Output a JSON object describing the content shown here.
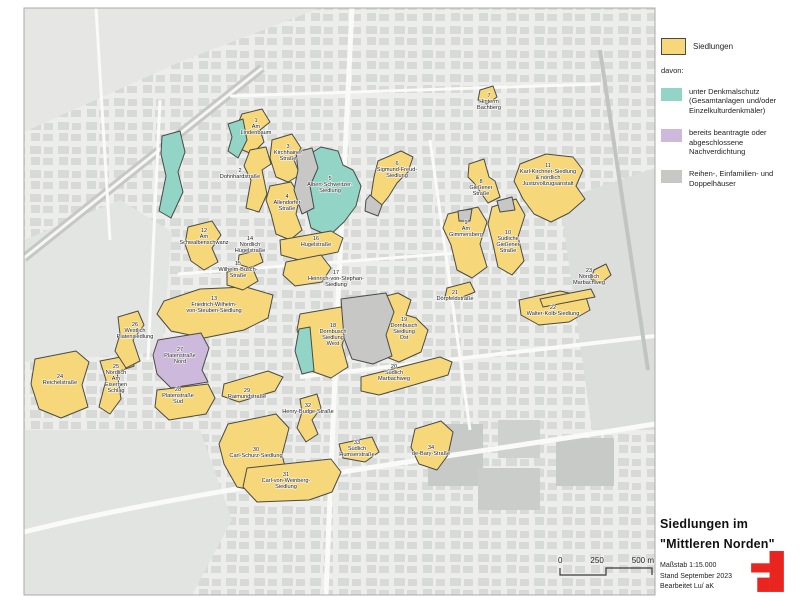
{
  "panel": {
    "legend": {
      "siedlungen_label": "Siedlungen",
      "davon_label": "davon:",
      "siedlungen_color": "#F6D87A",
      "items": [
        {
          "label": "unter Denkmalschutz (Gesamtanlagen und/oder Einzelkulturdenkmäler)",
          "color": "#92D4C5"
        },
        {
          "label": "bereits beantragte oder abgeschlossene Nachverdichtung",
          "color": "#CDB9DC"
        },
        {
          "label": "Reihen-, Einfamilien- und Doppelhäuser",
          "color": "#C7C7C5"
        }
      ]
    },
    "titleblock": {
      "line1": "Siedlungen im",
      "line2": "\"Mittleren Norden\"",
      "maszstab": "Maßstab 1:15.000",
      "stand": "Stand September 2023",
      "bearbeitet": "Bearbeitet  Lu/ aK"
    },
    "logo_color": "#E8251F"
  },
  "scalebar": {
    "t0": "0",
    "t250": "250",
    "t500": "500 m"
  },
  "map": {
    "colors": {
      "siedlung": "#F6D87A",
      "denkmalschutz": "#92D4C5",
      "nachverdichtung": "#CDB9DC",
      "reihenhaeuser": "#C7C7C5",
      "outline": "#4a4a46"
    },
    "settlements": [
      {
        "num": "1",
        "lines": [
          "Am",
          "Lindenbaum"
        ],
        "type": "s",
        "lx": 256,
        "ly": 122,
        "pts": "242,114 262,109 270,122 260,130 264,142 252,154 238,148 236,128"
      },
      {
        "num": "2",
        "lines": [
          "Dohnhardstraße"
        ],
        "type": "s",
        "lx": 240,
        "ly": 172,
        "pts": "250,150 266,147 271,164 262,170 267,194 259,212 246,208 251,180 244,166"
      },
      {
        "num": "3",
        "lines": [
          "Kirchhainer",
          "Straße"
        ],
        "type": "s",
        "lx": 288,
        "ly": 148,
        "pts": "272,140 292,134 301,148 294,160 300,175 288,182 276,177 270,158"
      },
      {
        "num": "4",
        "lines": [
          "Allendorfer",
          "Straße"
        ],
        "type": "s",
        "lx": 287,
        "ly": 198,
        "pts": "270,186 291,182 300,196 296,214 302,230 290,240 276,234 271,214 266,200"
      },
      {
        "num": "5",
        "lines": [
          "Albert-Schweitzer-",
          "Siedlung"
        ],
        "type": "d",
        "lx": 330,
        "ly": 180,
        "pts": "305,157 321,147 338,151 343,165 353,170 361,186 356,206 344,222 329,236 311,228 305,204 298,184 300,167"
      },
      {
        "num": "6",
        "lines": [
          "Sigmund-Freud-",
          "Siedlung"
        ],
        "type": "s",
        "lx": 397,
        "ly": 165,
        "pts": "378,161 401,151 413,157 408,172 397,183 389,196 381,206 371,196 374,177"
      },
      {
        "num": "7",
        "lines": [
          "Hinterm",
          "Bachberg"
        ],
        "type": "s",
        "lx": 489,
        "ly": 97,
        "pts": "480,90 493,86 497,97 487,104 478,100"
      },
      {
        "num": "8",
        "lines": [
          "Gießener",
          "Straße"
        ],
        "type": "s",
        "lx": 481,
        "ly": 183,
        "pts": "469,164 484,159 489,177 495,181 500,197 488,203 481,193 474,183 468,177"
      },
      {
        "num": "9",
        "lines": [
          "Am",
          "Gimmersberg"
        ],
        "type": "s",
        "lx": 466,
        "ly": 224,
        "pts": "448,214 478,207 487,222 480,244 487,267 472,278 457,270 451,245 443,228"
      },
      {
        "num": "10",
        "lines": [
          "Südliche",
          "Gießener",
          "Straße"
        ],
        "type": "s",
        "lx": 508,
        "ly": 234,
        "pts": "492,207 516,199 525,215 518,237 524,261 512,275 498,267 493,244 488,224"
      },
      {
        "num": "11",
        "lines": [
          "Karl-Kirchner-Siedlung",
          "& nördlich",
          "Justizvollzugsanstalt"
        ],
        "type": "s",
        "lx": 548,
        "ly": 167,
        "pts": "520,164 546,154 573,157 583,170 576,186 585,199 569,213 551,222 534,214 523,199 514,181"
      },
      {
        "num": "12",
        "lines": [
          "Am",
          "Schwalbenschwanz"
        ],
        "type": "s",
        "lx": 204,
        "ly": 232,
        "pts": "188,227 212,221 221,235 212,248 218,262 204,270 191,261 185,244"
      },
      {
        "num": "13",
        "lines": [
          "Friedrich-Wilhelm-",
          "von-Steuben-Siedlung"
        ],
        "type": "s",
        "lx": 214,
        "ly": 300,
        "pts": "164,301 200,289 246,287 273,295 268,318 244,330 204,338 171,331 157,314"
      },
      {
        "num": "14",
        "lines": [
          "Nördlich",
          "Hügelstraße"
        ],
        "type": "s",
        "lx": 250,
        "ly": 240,
        "pts": "239,255 259,250 263,262 250,268 238,264"
      },
      {
        "num": "15",
        "lines": [
          "Wilhelm-Busch-",
          "Straße"
        ],
        "type": "s",
        "lx": 238,
        "ly": 265,
        "pts": "227,272 252,267 258,281 243,290 227,285"
      },
      {
        "num": "16",
        "lines": [
          "Hügelstraße"
        ],
        "type": "s",
        "lx": 316,
        "ly": 240,
        "pts": "280,240 331,231 343,238 338,252 299,260 281,255"
      },
      {
        "num": "17",
        "lines": [
          "Heinrich-von-Stephan-",
          "Siedlung"
        ],
        "type": "s",
        "lx": 336,
        "ly": 274,
        "pts": "286,262 321,255 331,268 322,282 295,286 283,275"
      },
      {
        "num": "18",
        "lines": [
          "Dornbusch",
          "Siedlung",
          "West"
        ],
        "type": "s",
        "lx": 333,
        "ly": 327,
        "pts": "300,314 341,307 349,322 342,345 348,367 331,378 311,371 303,348 297,330"
      },
      {
        "num": "19",
        "lines": [
          "Dornbusch",
          "Siedlung",
          "Ost"
        ],
        "type": "s",
        "lx": 404,
        "ly": 321,
        "pts": "370,300 398,293 411,300 406,315 416,318 428,330 421,352 399,362 381,355 373,337 367,317"
      },
      {
        "num": "20",
        "lines": [
          "Südlich",
          "Marbachweg"
        ],
        "type": "s",
        "lx": 394,
        "ly": 368,
        "pts": "361,377 440,357 452,362 448,375 379,395 361,391"
      },
      {
        "num": "21",
        "lines": [
          "Dörpfeldstraße"
        ],
        "type": "s",
        "lx": 455,
        "ly": 294,
        "pts": "447,288 470,282 475,292 455,300 445,297"
      },
      {
        "num": "22",
        "lines": [
          "Walter-Kolb-Siedlung"
        ],
        "type": "s",
        "lx": 553,
        "ly": 309,
        "pts": "519,300 560,291 586,297 590,310 569,322 539,325 521,315"
      },
      {
        "num": "23",
        "lines": [
          "Nördlich",
          "Marbachweg"
        ],
        "type": "s",
        "lx": 589,
        "ly": 272,
        "pts": "540,299 591,289 595,297 543,307"
      },
      {
        "num": "",
        "lines": [],
        "type": "s",
        "lx": 0,
        "ly": 0,
        "pts": "594,270 606,264 611,275 601,283 591,279"
      },
      {
        "num": "24",
        "lines": [
          "Reichelstraße"
        ],
        "type": "s",
        "lx": 60,
        "ly": 378,
        "pts": "35,359 76,351 89,362 82,385 88,407 61,418 39,409 31,384"
      },
      {
        "num": "25",
        "lines": [
          "Nördlich",
          "Am",
          "Eisernen",
          "Schlag"
        ],
        "type": "s",
        "lx": 116,
        "ly": 368,
        "pts": "100,361 131,355 134,366 117,372 121,399 110,414 99,407 106,380"
      },
      {
        "num": "26",
        "lines": [
          "Westlich",
          "Platensiedlung"
        ],
        "type": "s",
        "lx": 135,
        "ly": 326,
        "pts": "118,317 138,311 144,325 133,340 140,361 126,368 115,351 120,334"
      },
      {
        "num": "27",
        "lines": [
          "Platenstraße",
          "Nord"
        ],
        "type": "n",
        "lx": 180,
        "ly": 351,
        "pts": "158,340 201,333 209,348 202,370 208,382 171,388 157,374 153,355"
      },
      {
        "num": "28",
        "lines": [
          "Platenstraße",
          "Süd"
        ],
        "type": "s",
        "lx": 178,
        "ly": 391,
        "pts": "157,390 208,384 215,398 206,414 169,420 155,407"
      },
      {
        "num": "29",
        "lines": [
          "Raimundstraße"
        ],
        "type": "s",
        "lx": 247,
        "ly": 392,
        "pts": "224,384 268,371 283,377 275,391 239,402 222,396"
      },
      {
        "num": "30",
        "lines": [
          "Carl-Schurz-Siedlung"
        ],
        "type": "s",
        "lx": 256,
        "ly": 451,
        "pts": "228,424 276,414 289,428 282,455 288,478 261,492 237,487 224,464 219,444"
      },
      {
        "num": "31",
        "lines": [
          "Carl-von-Weinberg-",
          "Siedlung"
        ],
        "type": "s",
        "lx": 286,
        "ly": 476,
        "pts": "247,468 331,459 341,472 332,492 309,500 257,502 243,487"
      },
      {
        "num": "32",
        "lines": [
          "Henry-Budge-Straße"
        ],
        "type": "s",
        "lx": 308,
        "ly": 407,
        "pts": "300,399 317,394 321,408 312,420 318,434 306,442 297,428 302,412"
      },
      {
        "num": "33",
        "lines": [
          "Südlich",
          "Humserstraße"
        ],
        "type": "s",
        "lx": 357,
        "ly": 444,
        "pts": "339,444 372,437 379,452 365,462 343,458"
      },
      {
        "num": "34",
        "lines": [
          "de-Bary-Straße"
        ],
        "type": "s",
        "lx": 431,
        "ly": 449,
        "pts": "415,429 441,421 453,432 448,455 437,470 419,464 411,447"
      },
      {
        "num": "",
        "lines": [],
        "type": "d",
        "lx": 0,
        "ly": 0,
        "pts": "162,136 180,131 185,152 178,172 183,192 171,218 159,211 166,176 161,154"
      },
      {
        "num": "",
        "lines": [],
        "type": "d",
        "lx": 0,
        "ly": 0,
        "pts": "228,124 243,119 247,140 238,158 228,151 232,137"
      },
      {
        "num": "",
        "lines": [],
        "type": "d",
        "lx": 0,
        "ly": 0,
        "pts": "299,329 310,327 314,371 302,374 295,351"
      },
      {
        "num": "",
        "lines": [],
        "type": "r",
        "lx": 0,
        "ly": 0,
        "pts": "341,299 386,293 394,312 386,335 392,356 373,364 352,359 344,338"
      },
      {
        "num": "",
        "lines": [],
        "type": "r",
        "lx": 0,
        "ly": 0,
        "pts": "370,195 382,205 378,216 365,211 366,200"
      },
      {
        "num": "",
        "lines": [],
        "type": "r",
        "lx": 0,
        "ly": 0,
        "pts": "497,201 512,197 515,210 500,212"
      },
      {
        "num": "",
        "lines": [],
        "type": "r",
        "lx": 0,
        "ly": 0,
        "pts": "458,211 472,209 470,221 459,221"
      },
      {
        "num": "",
        "lines": [],
        "type": "r",
        "lx": 0,
        "ly": 0,
        "pts": "296,152 312,148 318,168 310,186 314,208 302,214 294,190 298,170"
      }
    ]
  }
}
